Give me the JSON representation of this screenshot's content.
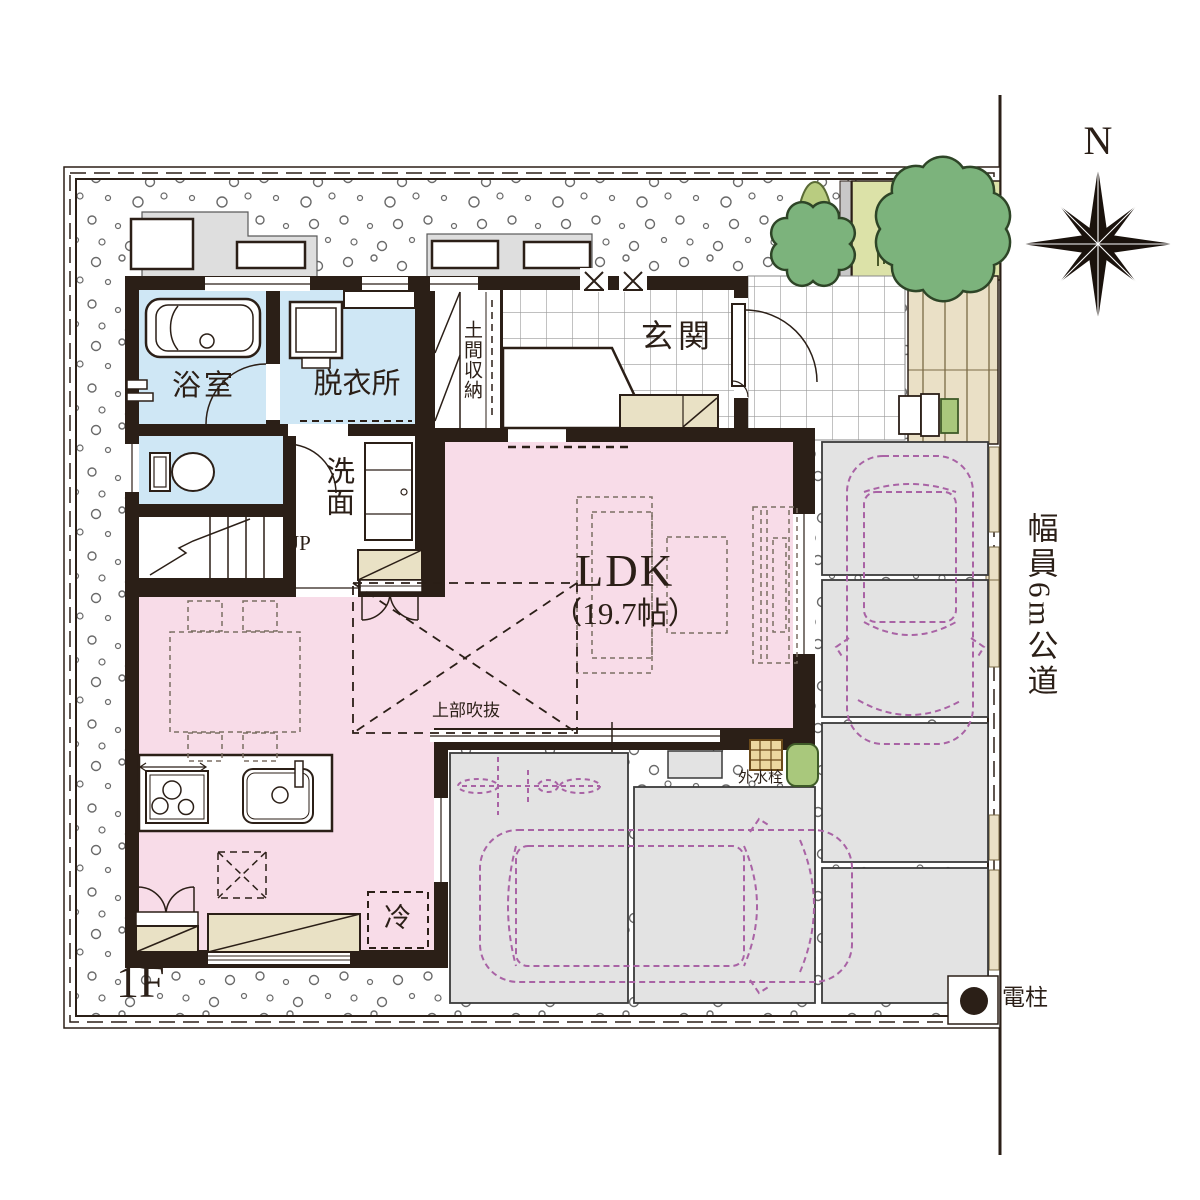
{
  "plan": {
    "floor": "1F",
    "compass": "N",
    "road": "幅員6m公道",
    "rooms": {
      "ldk": "LDK",
      "ldk_size": "（19.7帖）",
      "genkan": "玄関",
      "doma": "土間収納",
      "bath": "浴室",
      "dressing": "脱衣所",
      "washroom": "洗面",
      "stairs": "UP",
      "void_above": "上部吹抜",
      "fridge": "冷"
    },
    "annotations": {
      "outdoor_faucet": "外水栓",
      "utility_pole": "電柱"
    },
    "colors": {
      "ink": "#2b1f17",
      "ldk_pink": "#f8dce8",
      "wet_blue": "#cfe7f5",
      "parking_gray": "#e3e3e3",
      "cabinet_beige": "#e9e1c5",
      "deck_beige": "#eae0c6",
      "planting_green": "#dce2a8",
      "tree_green": "#7cb37c",
      "car_purple": "#a963a5"
    }
  }
}
